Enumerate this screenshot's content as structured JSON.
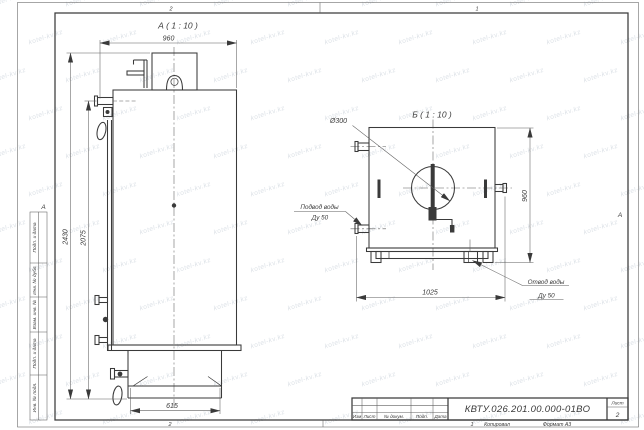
{
  "sheet": {
    "zones_top": [
      "2",
      "1"
    ],
    "zones_bottom": [
      "2",
      "1"
    ],
    "fold_left": "А",
    "fold_right": "А",
    "copied_label": "Копировал",
    "format_label": "Формат А3",
    "margin_rows": [
      "Подп. и дата",
      "Инв. № дубл.",
      "Взам. инв. №",
      "Подп. и дата",
      "Инв. № подл."
    ]
  },
  "title_block": {
    "designation": "КВТУ.026.201.00.000-01ВО",
    "header_cols": [
      "Изм",
      "Лист",
      "№ докум.",
      "Подп.",
      "Дата"
    ],
    "sheet_col_label": "Лист",
    "sheet_number": "2"
  },
  "view_a": {
    "title": "А ( 1 : 10 )",
    "dim_width": "960",
    "dim_height_total": "2430",
    "dim_height_body": "2075",
    "dim_base": "615"
  },
  "view_b": {
    "title": "Б ( 1 : 10 )",
    "dim_diameter": "Ø300",
    "dim_height": "960",
    "dim_width": "1025",
    "label_inlet_1": "Подвод воды",
    "label_inlet_2": "Ду 50",
    "label_outlet_1": "Отвод воды",
    "label_outlet_2": "Ду 50"
  },
  "watermark": {
    "text": "kotel-kv.kz"
  },
  "colors": {
    "line": "#3a3a3a",
    "thin": "#5f5f5f",
    "watermark": "#bfc8d2"
  }
}
